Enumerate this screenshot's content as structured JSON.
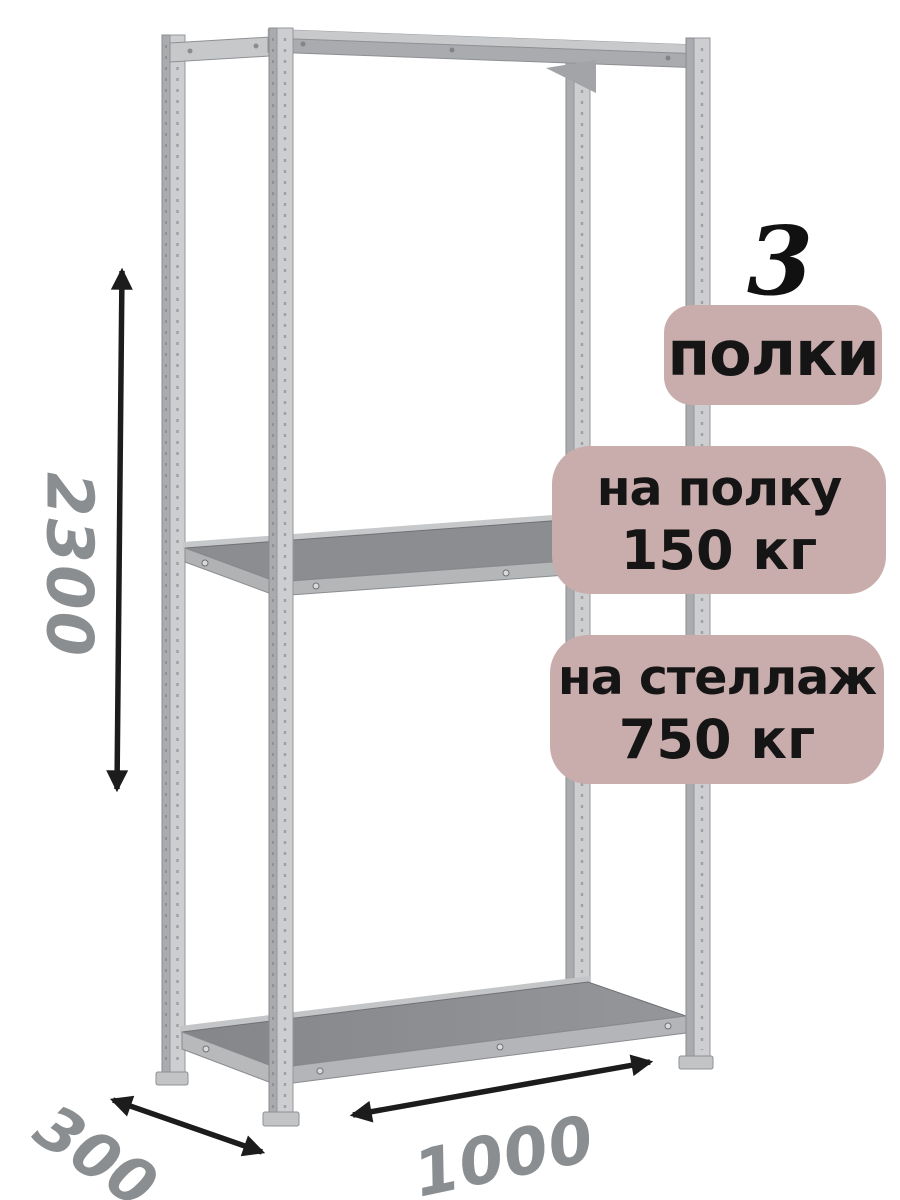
{
  "badges": {
    "count_value": "3",
    "count_label": "полки",
    "per_shelf": {
      "line1": "на полку",
      "line2": "150 кг"
    },
    "per_rack": {
      "line1": "на стеллаж",
      "line2": "750 кг"
    }
  },
  "dimensions": {
    "height_mm": "2300",
    "depth_mm": "300",
    "width_mm": "1000"
  },
  "icons": {
    "height_arrow": "double-headed-vertical-dimension-arrow",
    "depth_arrow": "double-headed-diagonal-dimension-arrow",
    "width_arrow": "double-headed-horizontal-dimension-arrow"
  },
  "colors": {
    "background": "#ffffff",
    "badge_bg": "#c9acac",
    "badge_text": "#151515",
    "dimension_text": "#8b8e90",
    "arrow": "#1c1c1c",
    "metal_light": "#ccced0",
    "metal_shadow": "#a9abae",
    "shelf_surface": "#8b8d90"
  }
}
